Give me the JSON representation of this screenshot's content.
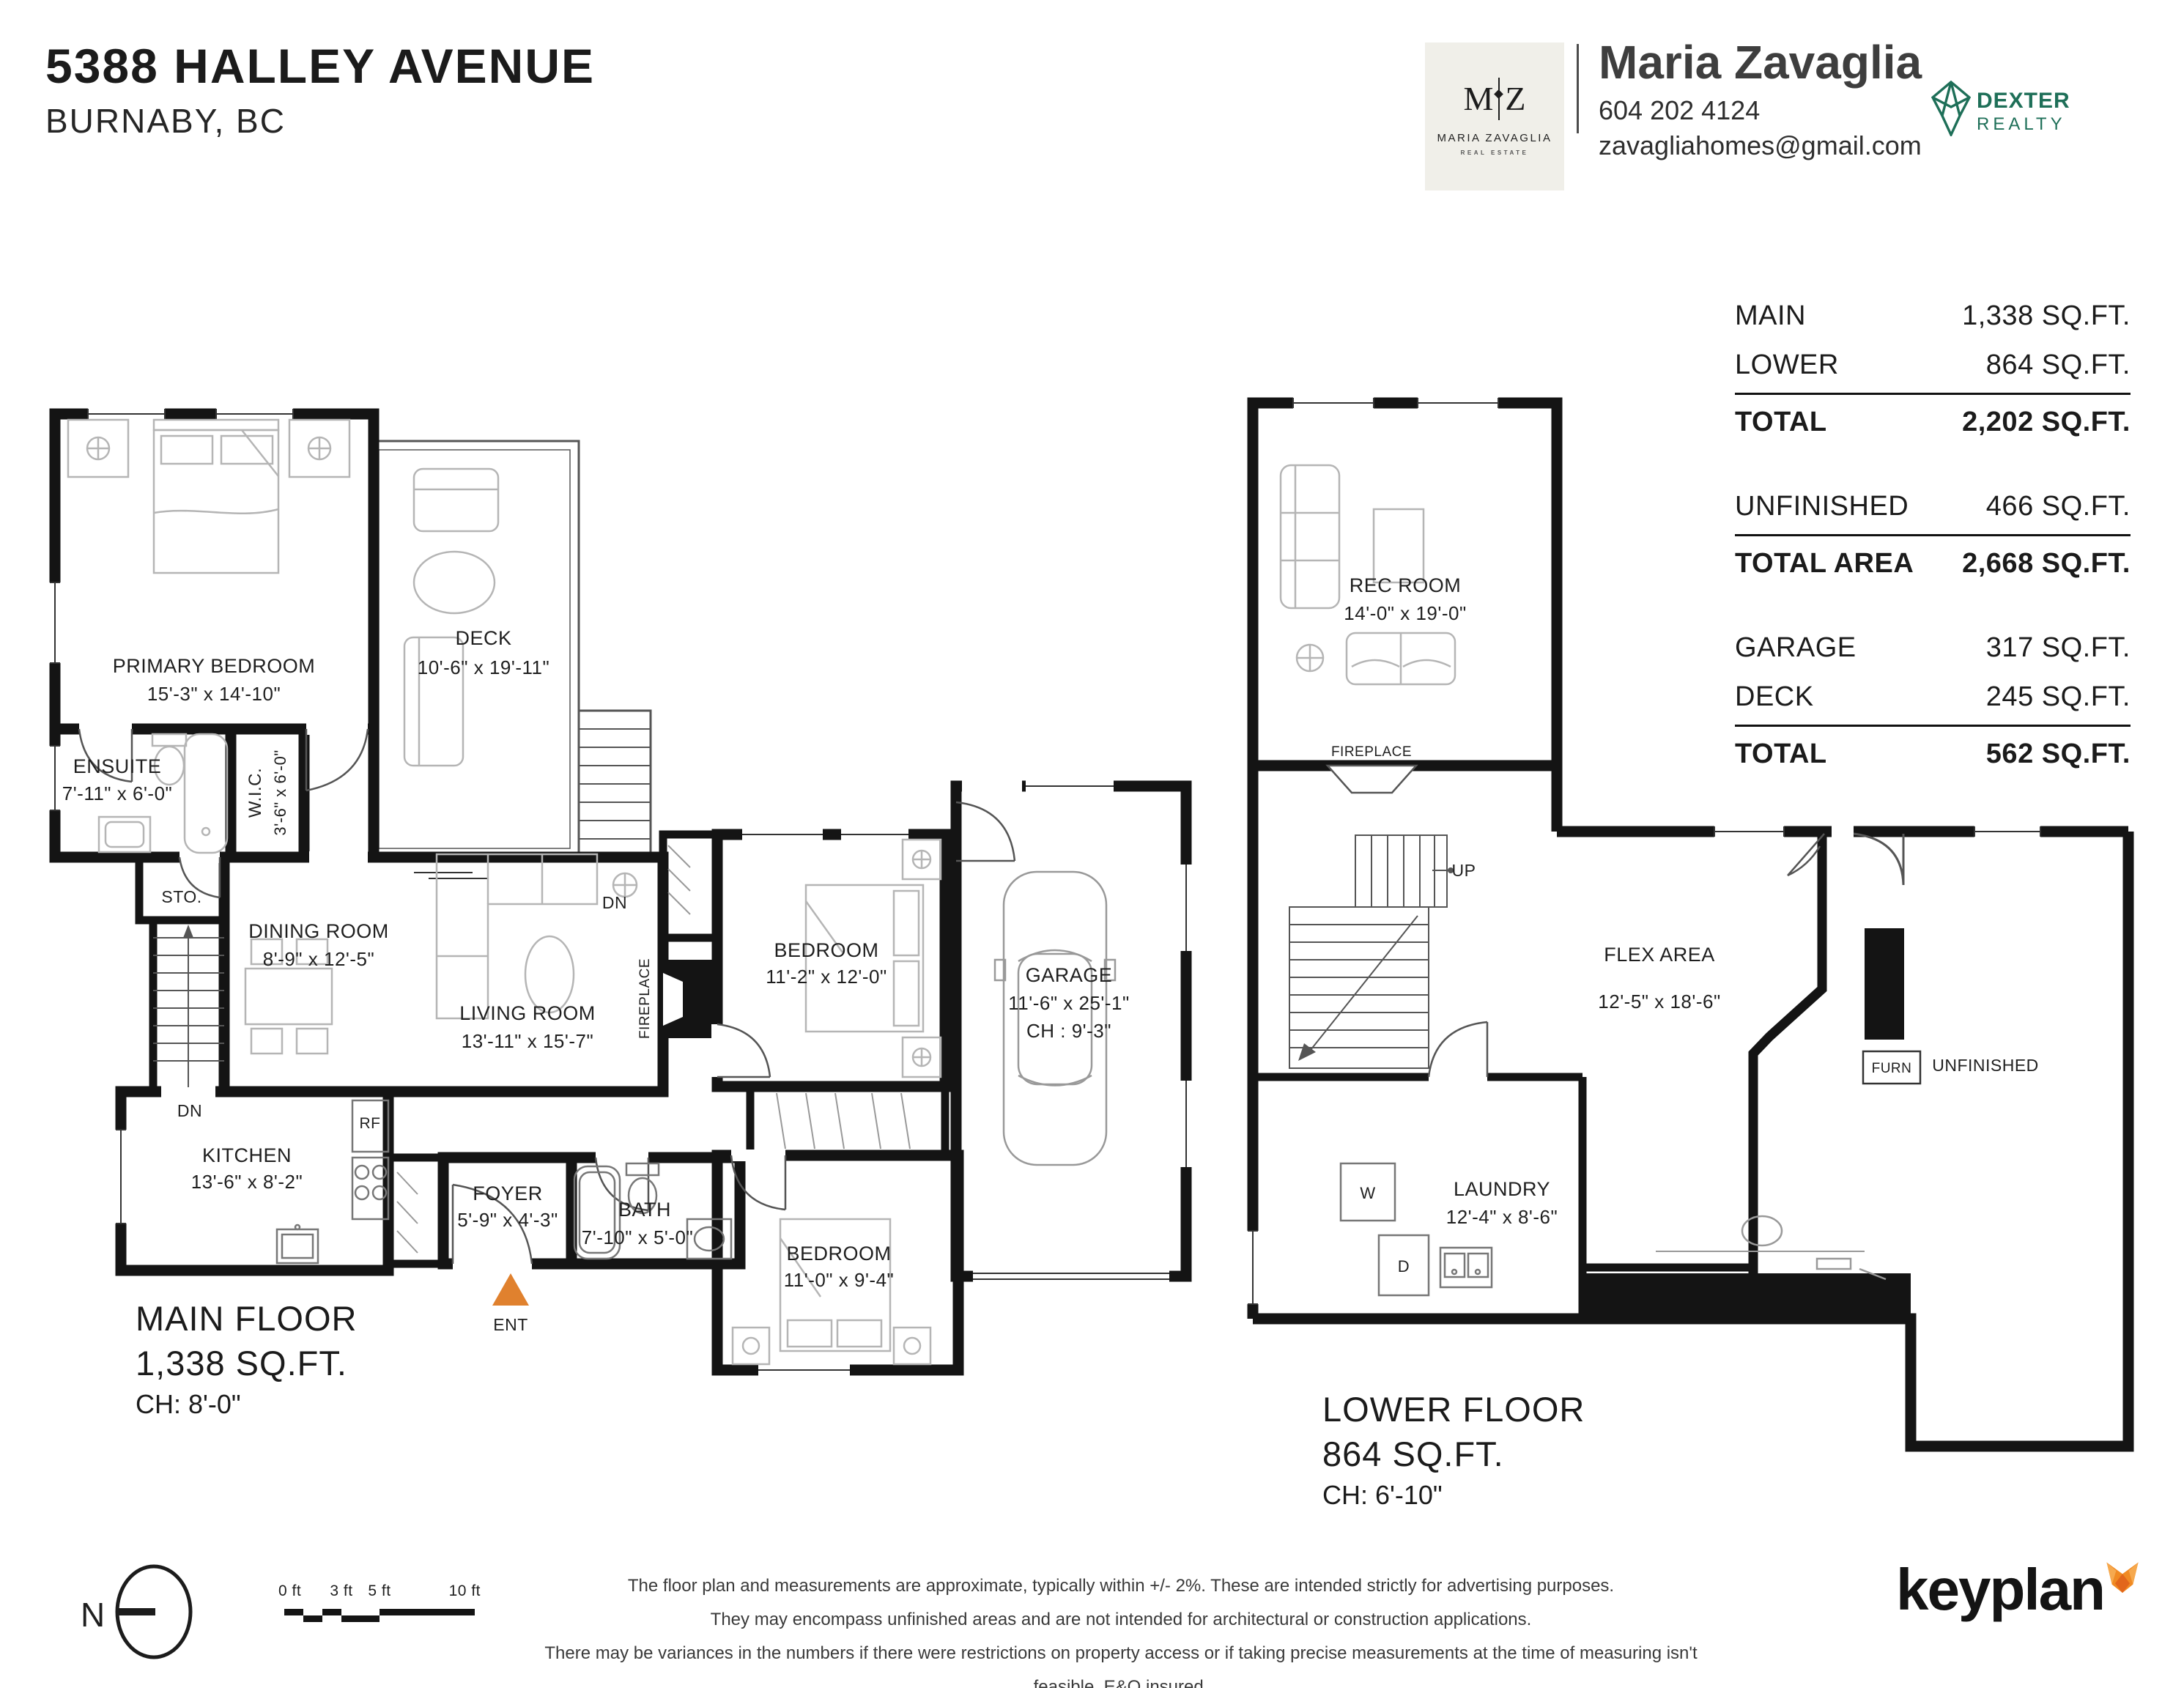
{
  "colors": {
    "wall": "#141414",
    "accent_orange": "#E0812E",
    "brand_green": "#1E6F58",
    "fox_orange": "#F08A23",
    "fox_dark": "#E2661B",
    "card_bg": "#F0EFE9"
  },
  "header": {
    "address": "5388 HALLEY AVENUE",
    "city": "BURNABY, BC",
    "logo_card": {
      "monogram_left": "M",
      "monogram_right": "Z",
      "name": "MARIA ZAVAGLIA",
      "tagline": "REAL ESTATE"
    },
    "agent": {
      "name": "Maria Zavaglia",
      "phone": "604 202 4124",
      "email": "zavagliahomes@gmail.com"
    },
    "brokerage": {
      "name": "DEXTER",
      "division": "REALTY"
    }
  },
  "stats": {
    "groups": [
      {
        "rows": [
          {
            "label": "MAIN",
            "value": "1,338 SQ.FT."
          },
          {
            "label": "LOWER",
            "value": "864 SQ.FT."
          }
        ],
        "total": {
          "label": "TOTAL",
          "value": "2,202 SQ.FT."
        }
      },
      {
        "rows": [
          {
            "label": "UNFINISHED",
            "value": "466 SQ.FT."
          }
        ],
        "total": {
          "label": "TOTAL AREA",
          "value": "2,668 SQ.FT."
        }
      },
      {
        "rows": [
          {
            "label": "GARAGE",
            "value": "317 SQ.FT."
          },
          {
            "label": "DECK",
            "value": "245 SQ.FT."
          }
        ],
        "total": {
          "label": "TOTAL",
          "value": "562 SQ.FT."
        }
      }
    ]
  },
  "main_floor": {
    "title": "MAIN FLOOR",
    "area": "1,338 SQ.FT.",
    "ceiling": "CH: 8'-0\"",
    "rooms": {
      "primary_bedroom": {
        "name": "PRIMARY BEDROOM",
        "dims": "15'-3\" x 14'-10\""
      },
      "deck": {
        "name": "DECK",
        "dims": "10'-6\" x 19'-11\""
      },
      "ensuite": {
        "name": "ENSUITE",
        "dims": "7'-11\" x 6'-0\""
      },
      "wic": {
        "name": "W.I.C.",
        "dims": "3'-6\" x 6'-0\""
      },
      "storage": {
        "name": "STO."
      },
      "dining": {
        "name": "DINING ROOM",
        "dims": "8'-9\" x 12'-5\""
      },
      "living": {
        "name": "LIVING ROOM",
        "dims": "13'-11\" x 15'-7\""
      },
      "kitchen": {
        "name": "KITCHEN",
        "dims": "13'-6\" x 8'-2\""
      },
      "foyer": {
        "name": "FOYER",
        "dims": "5'-9\" x 4'-3\""
      },
      "bath": {
        "name": "BATH",
        "dims": "7'-10\" x 5'-0\""
      },
      "bedroom_mid": {
        "name": "BEDROOM",
        "dims": "11'-2\" x 12'-0\""
      },
      "bedroom_front": {
        "name": "BEDROOM",
        "dims": "11'-0\" x 9'-4\""
      },
      "garage": {
        "name": "GARAGE",
        "dims": "11'-6\" x 25'-1\"",
        "ceiling": "CH : 9'-3\""
      }
    },
    "labels": {
      "fireplace": "FIREPLACE",
      "fridge": "RF",
      "stairs_down": "DN",
      "deck_down": "DN",
      "entry": "ENT"
    }
  },
  "lower_floor": {
    "title": "LOWER FLOOR",
    "area": "864 SQ.FT.",
    "ceiling": "CH: 6'-10\"",
    "rooms": {
      "rec": {
        "name": "REC ROOM",
        "dims": "14'-0\" x 19'-0\""
      },
      "flex": {
        "name": "FLEX AREA",
        "dims": "12'-5\" x 18'-6\""
      },
      "laundry": {
        "name": "LAUNDRY",
        "dims": "12'-4\" x 8'-6\""
      }
    },
    "labels": {
      "fireplace": "FIREPLACE",
      "stairs_up": "UP",
      "furnace": "FURN",
      "unfinished": "UNFINISHED",
      "washer": "W",
      "dryer": "D"
    }
  },
  "footer": {
    "north": "N",
    "scale_ticks": [
      "0 ft",
      "3 ft",
      "5 ft",
      "10 ft"
    ],
    "disclaimer": [
      "The floor plan and measurements are approximate, typically within +/- 2%. These are intended strictly for advertising purposes.",
      "They may encompass unfinished areas and are not intended for architectural or construction applications.",
      "There may be variances in the numbers if there were restrictions on property access or if taking precise measurements at the time of measuring isn't feasible. E&O insured."
    ],
    "brand": "keyplan"
  }
}
